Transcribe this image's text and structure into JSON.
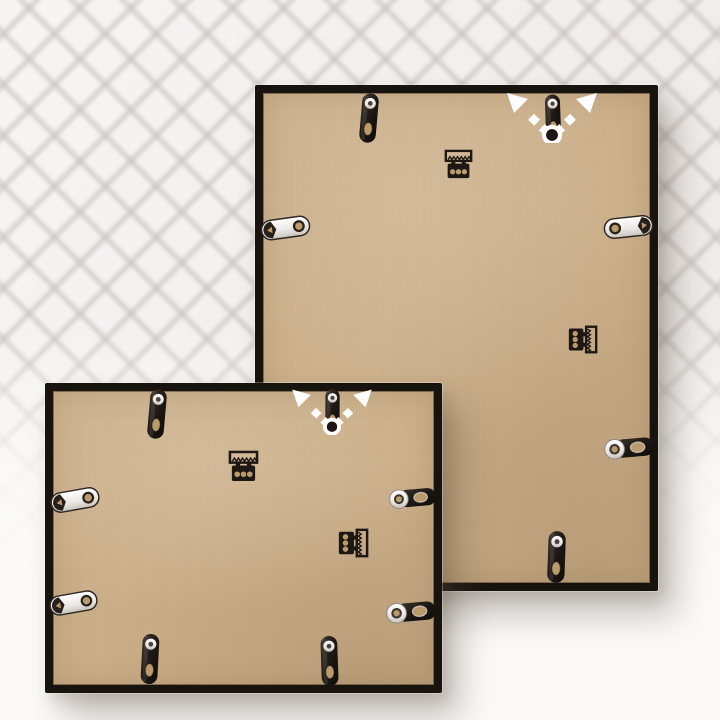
{
  "canvas": {
    "width": 720,
    "height": 720
  },
  "colors": {
    "pattern-base": "#f3f1ef",
    "pattern-line": "#cfcac5",
    "surface-white": "#fbfaf8",
    "frame-black": "#17130f",
    "board-tan": "#cbae87",
    "hole-tan": "#bb9a6c",
    "metal-dark": "#1d1814",
    "metal-bright": "#f2f0ed",
    "arrow-white": "#ffffff",
    "shadow-soft": "rgba(88,76,62,0.32)"
  },
  "scene": {
    "description": "Product photo: rear view of two black picture frames leaning against a white quilted wall on a white surface. Each back shows a tan MDF board held by black and silver flex tabs, one horizontal and one vertical sawtooth hanger, and white dashed arrows over the top tab showing the two hanging directions.",
    "background": "white quilted diamond wall fading to plain white tabletop",
    "frames": [
      {
        "id": "large-frame-back",
        "orientation": "portrait",
        "x": 255,
        "y": 85,
        "width": 403,
        "height": 506,
        "border": 8,
        "hardware": [
          {
            "type": "flex-tab",
            "x": 103,
            "y": 7,
            "w": 22,
            "h": 52,
            "rot": 5
          },
          {
            "type": "flex-tab",
            "x": 288,
            "y": 5,
            "w": 20,
            "h": 54,
            "rot": -2
          },
          {
            "type": "hanging-arrows",
            "x": 245,
            "y": 2,
            "w": 104,
            "h": 56
          },
          {
            "type": "sawtooth-hanger-horizontal",
            "x": 189,
            "y": 63,
            "w": 29,
            "h": 33
          },
          {
            "type": "flex-tab-silver",
            "x": 4,
            "y": 130,
            "w": 53,
            "h": 26,
            "rot": -8
          },
          {
            "type": "flex-tab-silver",
            "x": 348,
            "y": 129,
            "w": 51,
            "h": 26,
            "rot": 6,
            "flip": true
          },
          {
            "type": "sawtooth-hanger-vertical",
            "x": 312,
            "y": 239,
            "w": 31,
            "h": 31
          },
          {
            "type": "flex-tab-grommet",
            "x": 348,
            "y": 349,
            "w": 52,
            "h": 28,
            "rot": -5
          },
          {
            "type": "flex-tab",
            "x": 290,
            "y": 445,
            "w": 23,
            "h": 54,
            "rot": 2
          }
        ]
      },
      {
        "id": "small-frame-back",
        "orientation": "landscape",
        "x": 45,
        "y": 383,
        "width": 397,
        "height": 310,
        "border": 8,
        "hardware": [
          {
            "type": "flex-tab",
            "x": 101,
            "y": 5,
            "w": 22,
            "h": 52,
            "rot": 5
          },
          {
            "type": "flex-tab",
            "x": 278,
            "y": 3,
            "w": 19,
            "h": 49,
            "rot": 0
          },
          {
            "type": "hanging-arrows",
            "x": 241,
            "y": 0,
            "w": 92,
            "h": 52
          },
          {
            "type": "sawtooth-hanger-horizontal",
            "x": 183,
            "y": 67,
            "w": 31,
            "h": 33
          },
          {
            "type": "flex-tab-silver",
            "x": 5,
            "y": 104,
            "w": 50,
            "h": 26,
            "rot": -10
          },
          {
            "type": "flex-tab-silver",
            "x": 4,
            "y": 207,
            "w": 49,
            "h": 26,
            "rot": -10
          },
          {
            "type": "flex-tab-grommet",
            "x": 343,
            "y": 101,
            "w": 49,
            "h": 28,
            "rot": -5
          },
          {
            "type": "flex-tab-grommet",
            "x": 340,
            "y": 215,
            "w": 52,
            "h": 28,
            "rot": -5
          },
          {
            "type": "sawtooth-hanger-vertical",
            "x": 292,
            "y": 144,
            "w": 32,
            "h": 32
          },
          {
            "type": "flex-tab",
            "x": 93,
            "y": 250,
            "w": 24,
            "h": 52,
            "rot": 3
          },
          {
            "type": "flex-tab",
            "x": 272,
            "y": 252,
            "w": 25,
            "h": 52,
            "rot": -2
          }
        ]
      }
    ]
  }
}
